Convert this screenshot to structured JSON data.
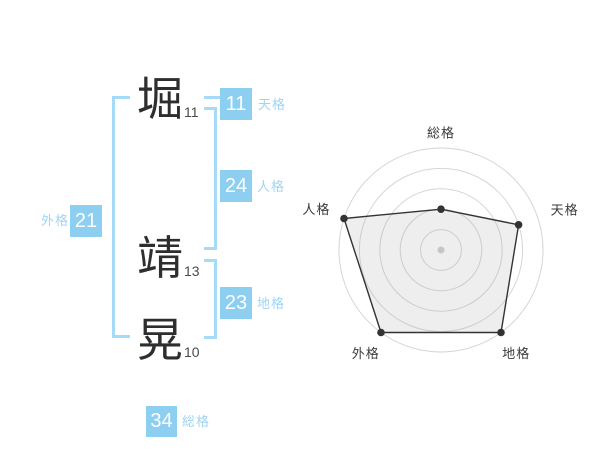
{
  "name": {
    "characters": [
      {
        "char": "堀",
        "strokes": "11"
      },
      {
        "char": "靖",
        "strokes": "13"
      },
      {
        "char": "晃",
        "strokes": "10"
      }
    ]
  },
  "scores": {
    "tenkaku": {
      "value": "11",
      "label": "天格"
    },
    "jinkaku": {
      "value": "24",
      "label": "人格"
    },
    "chikaku": {
      "value": "23",
      "label": "地格"
    },
    "gaikaku": {
      "value": "21",
      "label": "外格"
    },
    "soukaku": {
      "value": "34",
      "label": "総格"
    }
  },
  "colors": {
    "accent_blue": "#8dcff1",
    "label_blue": "#9ed5f3",
    "bracket_blue": "#a6dbf7",
    "text_dark": "#2e2e2e",
    "number_gray": "#4a4a4a"
  },
  "chart_data": {
    "type": "radar",
    "categories": [
      "総格",
      "天格",
      "地格",
      "外格",
      "人格"
    ],
    "values": [
      2,
      4,
      5,
      5,
      5
    ],
    "max": 5,
    "rings": 5,
    "title": "",
    "legend": "none",
    "grid": "concentric-circles",
    "ring_color": "#d6d6d6",
    "shape_fill": "rgba(160,160,160,0.18)",
    "shape_stroke": "#333333",
    "point_color": "#333333",
    "center_dot_color": "#c6c6c6",
    "label_color": "#3a3a3a",
    "layout": {
      "center_x": 143,
      "center_y": 142,
      "outer_radius": 102,
      "start_angle_deg": -90,
      "label_radius": [
        117,
        130,
        128,
        128,
        131
      ],
      "width": 300,
      "height": 262
    }
  }
}
